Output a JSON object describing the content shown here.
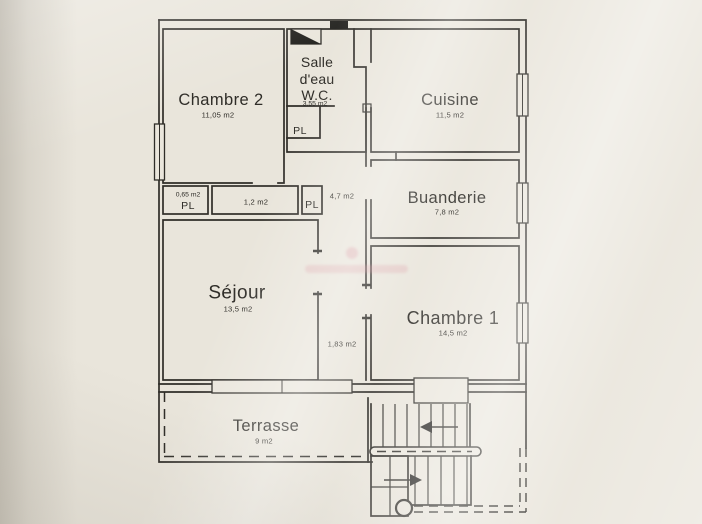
{
  "figure": {
    "kind": "floor-plan"
  },
  "rooms": [
    {
      "name": "Chambre 2",
      "area": "11,05 m2"
    },
    {
      "name_line1": "Salle",
      "name_line2": "d'eau",
      "name_line3": "W.C.",
      "area": "3,55 m2",
      "closet_label": "PL"
    },
    {
      "name": "Cuisine",
      "area": "11,5 m2"
    },
    {
      "name": "Buanderie",
      "area": "7,8 m2"
    },
    {
      "name": "Séjour",
      "area": "13,5 m2"
    },
    {
      "name": "Chambre 1",
      "area": "14,5 m2"
    },
    {
      "name": "Terrasse",
      "area": "9 m2"
    }
  ],
  "closets": [
    {
      "label": "PL",
      "area": "0,65 m2"
    },
    {
      "label": "PL"
    }
  ],
  "corridors": [
    {
      "area": "4,7 m2"
    },
    {
      "area": "1,2 m2"
    },
    {
      "area": "1,83 m2"
    }
  ],
  "colors": {
    "paper": "#e9e5db",
    "wall": "#2f2d28",
    "watermark_pink": "#d98f9b"
  }
}
